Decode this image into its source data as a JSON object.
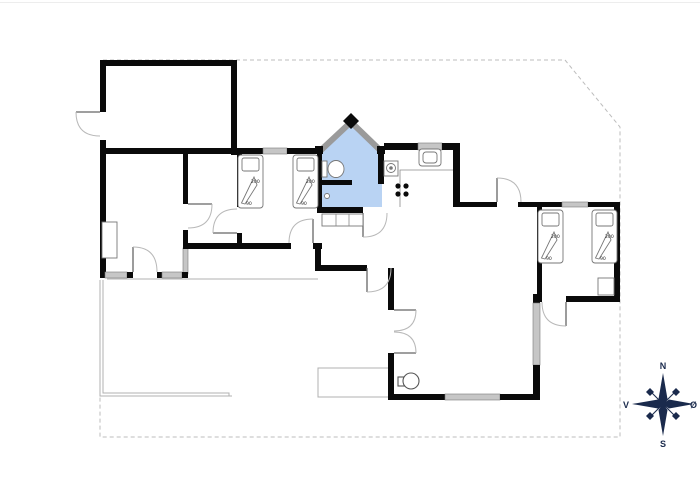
{
  "floor_plan": {
    "beds": [
      {
        "id": "bed-1",
        "room": "middle-bedroom",
        "length_label": "200",
        "width_label": "90"
      },
      {
        "id": "bed-2",
        "room": "middle-bedroom",
        "length_label": "200",
        "width_label": "90"
      },
      {
        "id": "bed-3",
        "room": "right-bedroom",
        "length_label": "200",
        "width_label": "90"
      },
      {
        "id": "bed-4",
        "room": "right-bedroom",
        "length_label": "200",
        "width_label": "90"
      }
    ],
    "compass": {
      "north_label": "N",
      "south_label": "S",
      "west_label": "V",
      "east_label": "Ø"
    },
    "colors": {
      "wall": "#0a0a0a",
      "bathroom_fill": "#b9d3f3",
      "window_fill": "#c6c6c6",
      "boundary_dash": "#bdbdbd",
      "terrace_line": "#b0b0b0",
      "compass": "#1a2a4c"
    },
    "fixtures": [
      "toilet",
      "shower-drain",
      "kitchen-sink",
      "oven",
      "cooktop-burners",
      "wood-stove",
      "wardrobe-3-section",
      "bedroom-closet",
      "left-room-wardrobe",
      "terrace-outline",
      "entry-step",
      "property-boundary",
      "compass-rose"
    ]
  }
}
